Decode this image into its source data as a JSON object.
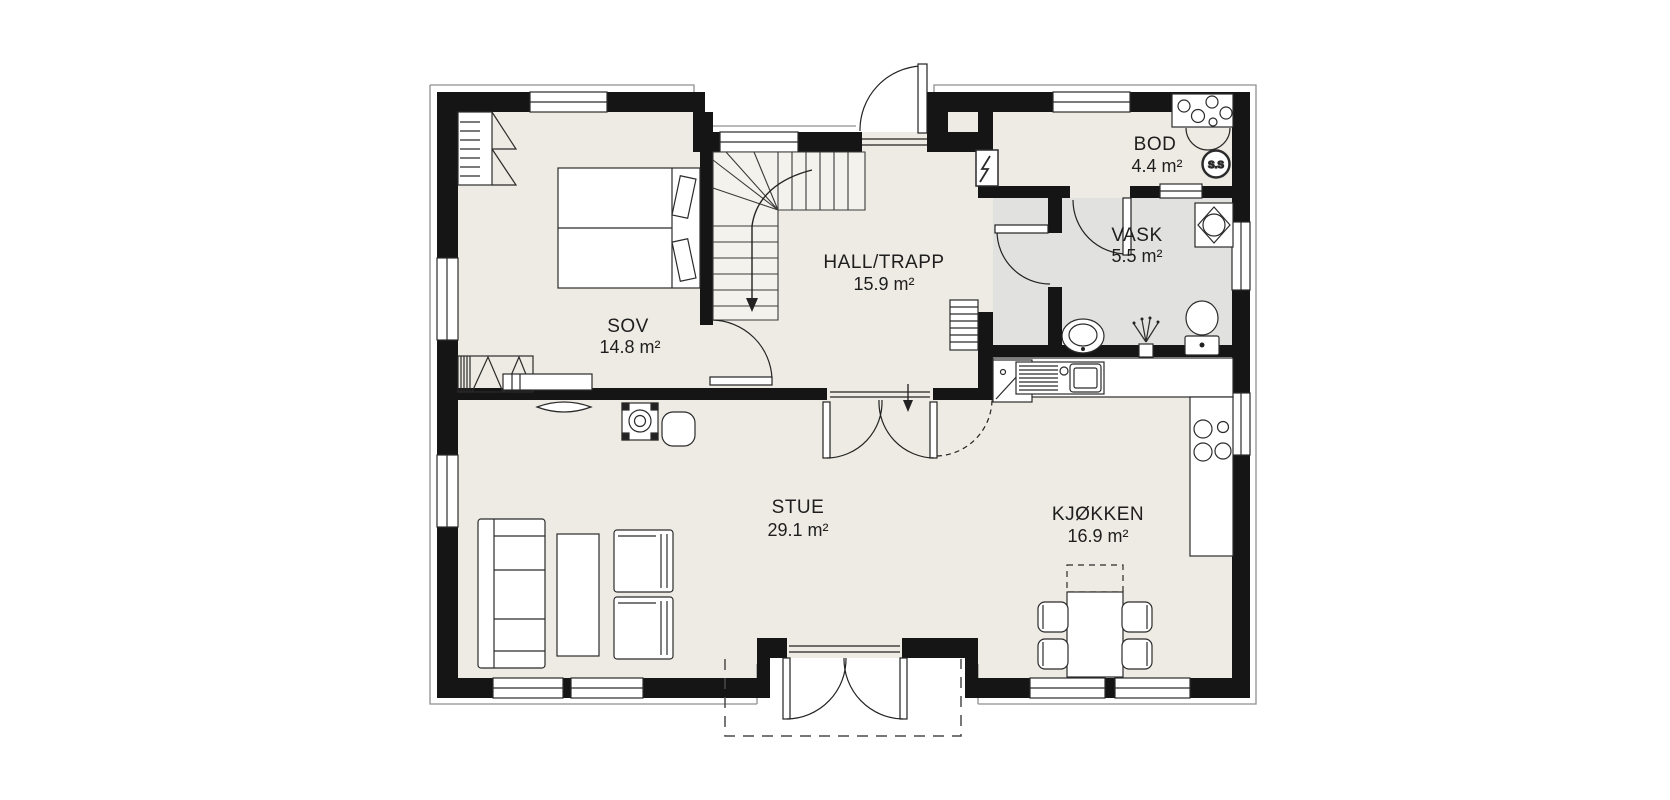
{
  "plan": {
    "type": "floor-plan",
    "rooms": {
      "sov": {
        "name": "SOV",
        "area": "14.8 m²"
      },
      "hall": {
        "name": "HALL/TRAPP",
        "area": "15.9 m²"
      },
      "bod": {
        "name": "BOD",
        "area": "4.4 m²"
      },
      "vask": {
        "name": "VASK",
        "area": "5.5 m²"
      },
      "stue": {
        "name": "STUE",
        "area": "29.1 m²"
      },
      "kjokken": {
        "name": "KJØKKEN",
        "area": "16.9 m²"
      }
    },
    "annotations": {
      "central_vacuum": "S.S"
    },
    "colors": {
      "wall": "#151515",
      "floor": "#edebe3",
      "floor_wet_room": "#e1e1df",
      "line": "#2b2b2b",
      "background": "#ffffff"
    }
  }
}
